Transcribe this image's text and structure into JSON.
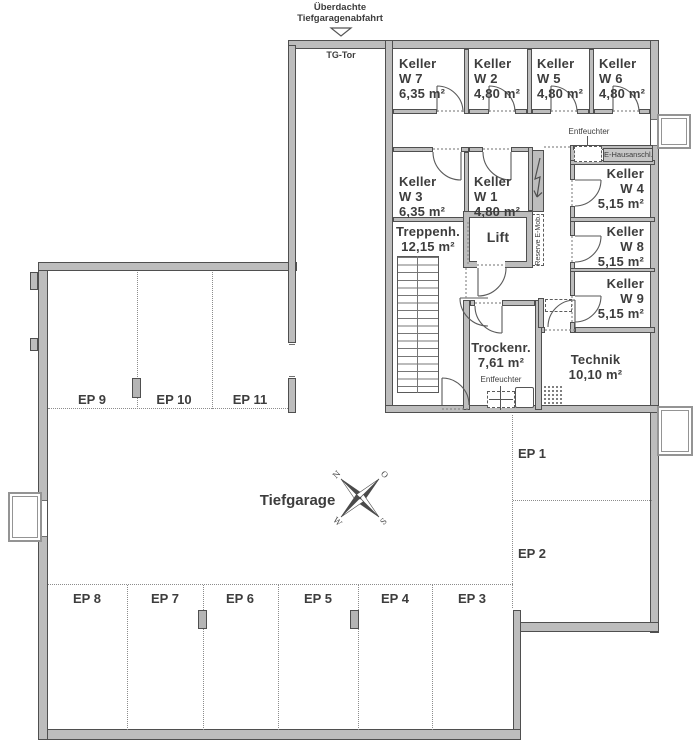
{
  "header": {
    "line1": "Überdachte",
    "line2": "Tiefgaragenabfahrt",
    "gate": "TG-Tor"
  },
  "rooms": {
    "w7": {
      "name": "Keller",
      "unit": "W 7",
      "area": "6,35 m²"
    },
    "w2": {
      "name": "Keller",
      "unit": "W 2",
      "area": "4,80 m²"
    },
    "w5": {
      "name": "Keller",
      "unit": "W 5",
      "area": "4,80 m²"
    },
    "w6": {
      "name": "Keller",
      "unit": "W 6",
      "area": "4,80 m²"
    },
    "w3": {
      "name": "Keller",
      "unit": "W 3",
      "area": "6,35 m²"
    },
    "w1": {
      "name": "Keller",
      "unit": "W 1",
      "area": "4,80 m²"
    },
    "w4": {
      "name": "Keller",
      "unit": "W 4",
      "area": "5,15 m²"
    },
    "w8": {
      "name": "Keller",
      "unit": "W 8",
      "area": "5,15 m²"
    },
    "w9": {
      "name": "Keller",
      "unit": "W 9",
      "area": "5,15 m²"
    },
    "treppenhaus": {
      "name": "Treppenh.",
      "area": "12,15 m²"
    },
    "lift": {
      "name": "Lift"
    },
    "trockenraum": {
      "name": "Trockenr.",
      "area": "7,61 m²"
    },
    "technik": {
      "name": "Technik",
      "area": "10,10 m²"
    }
  },
  "garage": {
    "label": "Tiefgarage"
  },
  "parking": {
    "ep1": "EP 1",
    "ep2": "EP 2",
    "ep3": "EP 3",
    "ep4": "EP 4",
    "ep5": "EP 5",
    "ep6": "EP 6",
    "ep7": "EP 7",
    "ep8": "EP 8",
    "ep9": "EP 9",
    "ep10": "EP 10",
    "ep11": "EP 11"
  },
  "annotations": {
    "entfeuchter_top": "Entfeuchter",
    "entfeuchter_trockenraum": "Entfeuchter",
    "e_hausanschluss": "E-Hausanschl.",
    "reserve_emob": "Reserve E-Mob."
  },
  "compass": {
    "n": "N",
    "o": "O",
    "s": "S",
    "w": "W"
  },
  "colors": {
    "wall": "#bdbdbd",
    "outline": "#4f4f4f",
    "text": "#3d3d3d",
    "dotted": "#8c8c8c"
  }
}
